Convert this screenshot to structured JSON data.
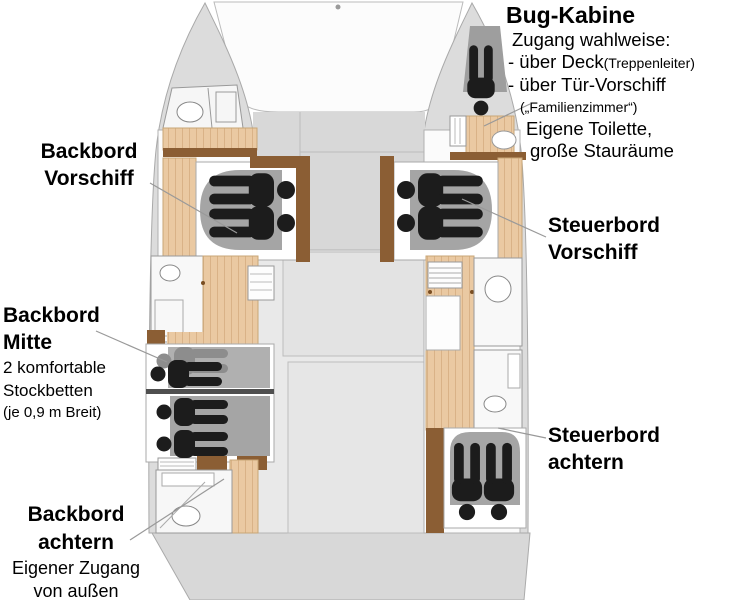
{
  "plan": {
    "type": "catamaran-deck-plan",
    "colors": {
      "hull": "#dcdcdc",
      "deck": "#d8d8d8",
      "interior": "#fbfbfb",
      "wood_floor": "#eac9a2",
      "wood_trim": "#8b5e34",
      "bed_gray": "#a5a5a5",
      "person": "#1c1c1c",
      "person_secondary": "#8d8d8d",
      "leader_line": "#999999",
      "text": "#000000"
    },
    "cabins": [
      {
        "name": "Bug-Kabine",
        "sleepers_shown": 1
      },
      {
        "name": "Backbord Vorschiff",
        "sleepers_shown": 2
      },
      {
        "name": "Steuerbord Vorschiff",
        "sleepers_shown": 2
      },
      {
        "name": "Backbord Mitte",
        "sleepers_shown": 4
      },
      {
        "name": "Steuerbord achtern",
        "sleepers_shown": 2
      }
    ]
  },
  "labels": {
    "bug_kabine": {
      "title": "Bug-Kabine",
      "line1": "Zugang wahlweise:",
      "line2_main": "- über Deck",
      "line2_small": "(Treppenleiter)",
      "line3": "- über Tür-Vorschiff",
      "line4_small": "(„Familienzimmer“)",
      "line5": "Eigene Toilette,",
      "line6": "große Stauräume"
    },
    "backbord_vorschiff": {
      "line1": "Backbord",
      "line2": "Vorschiff"
    },
    "steuerbord_vorschiff": {
      "line1": "Steuerbord",
      "line2": "Vorschiff"
    },
    "backbord_mitte": {
      "line1": "Backbord",
      "line2": "Mitte",
      "desc1": "2 komfortable",
      "desc2": "Stockbetten",
      "desc3": "(je 0,9 m Breit)"
    },
    "steuerbord_achtern": {
      "line1": "Steuerbord",
      "line2": "achtern"
    },
    "backbord_achtern": {
      "line1": "Backbord",
      "line2": "achtern",
      "desc1": "Eigener Zugang",
      "desc2": "von außen"
    }
  }
}
